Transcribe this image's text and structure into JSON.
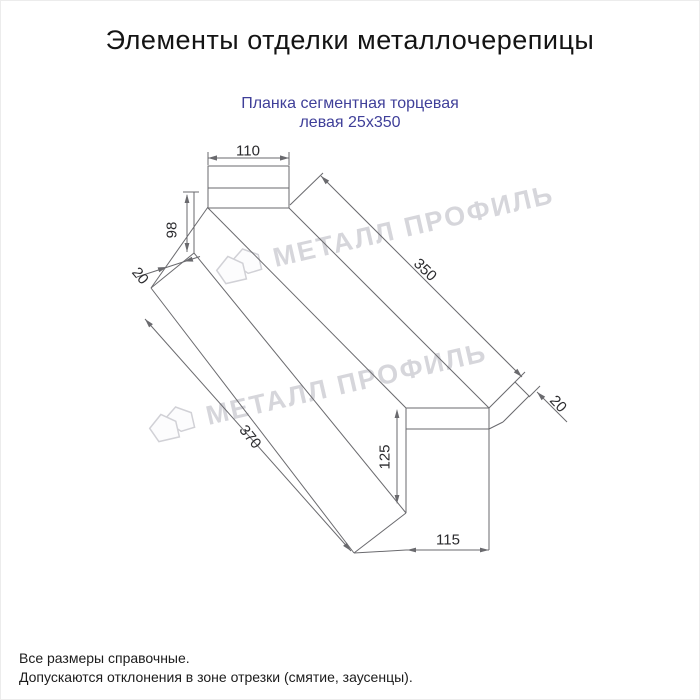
{
  "header": {
    "title": "Элементы отделки металлочерепицы"
  },
  "product": {
    "name_line1": "Планка сегментная торцевая",
    "name_line2": "левая 25x350",
    "accent_color": "#3f3f99"
  },
  "drawing": {
    "line_color": "#6a6a6e",
    "dimensions": {
      "top_width": "110",
      "far_end_height": "98",
      "far_end_lip": "20",
      "length_top": "350",
      "near_end_lip": "20",
      "length_bottom": "370",
      "near_end_height": "125",
      "near_end_width": "115"
    }
  },
  "watermark": {
    "text": "МЕТАЛЛ ПРОФИЛЬ",
    "logo_icon": "metall-profil-logo",
    "color": "#cfcfd5"
  },
  "footer": {
    "note1": "Все размеры справочные.",
    "note2": "Допускаются отклонения в зоне отрезки (смятие, заусенцы)."
  }
}
